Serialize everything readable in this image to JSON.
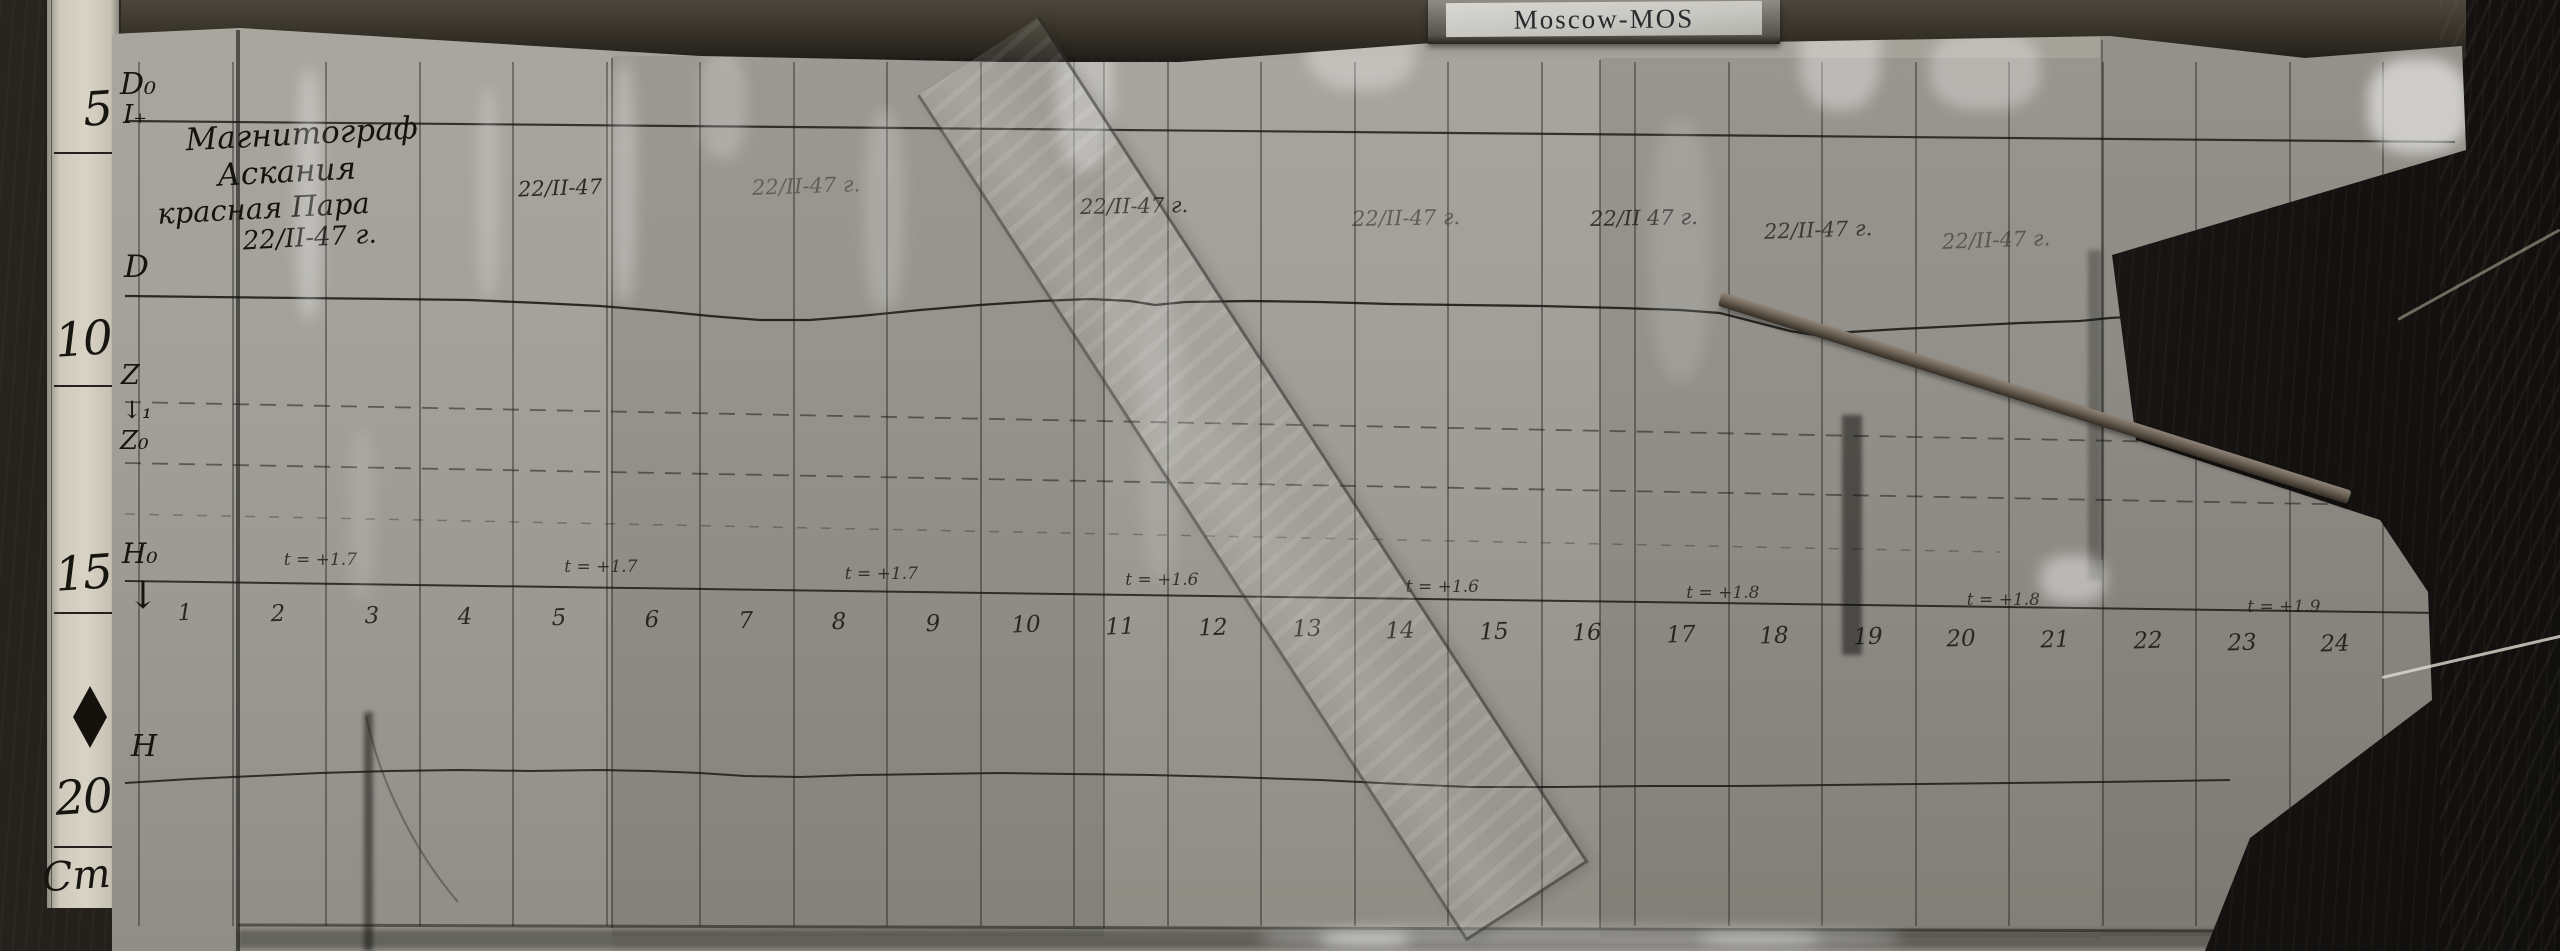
{
  "label_plate": {
    "text": "Moscow-MOS"
  },
  "colors": {
    "paper": "#a09b93",
    "wood": "#1e1c1a",
    "ink": "#1b1b1b",
    "ruler": "#d8d3c5"
  },
  "ruler": {
    "marks": [
      {
        "label": "5",
        "text_y": 86,
        "line_y": 152
      },
      {
        "label": "10",
        "text_y": 316,
        "line_y": 385
      },
      {
        "label": "15",
        "text_y": 550,
        "line_y": 612
      },
      {
        "label": "20",
        "text_y": 774,
        "line_y": 846
      }
    ],
    "unit": {
      "label": "Cm",
      "text_y": 856
    }
  },
  "title_block": {
    "lines": [
      {
        "text": "Магнитограф",
        "size": 31,
        "indent": 40
      },
      {
        "text": "Аскания",
        "size": 31,
        "indent": 70
      },
      {
        "text": "красная Пара",
        "size": 29,
        "indent": 8
      },
      {
        "text": "22/II-47 г.",
        "size": 26,
        "indent": 92
      }
    ]
  },
  "margin_labels": [
    {
      "label": "D₀",
      "x": 120,
      "y": 70,
      "s": 30
    },
    {
      "label": "I₊",
      "x": 123,
      "y": 102,
      "s": 26
    },
    {
      "label": "D",
      "x": 124,
      "y": 252,
      "s": 31
    },
    {
      "label": "Z",
      "x": 121,
      "y": 362,
      "s": 27
    },
    {
      "label": "↓₁",
      "x": 122,
      "y": 398,
      "s": 24
    },
    {
      "label": "Z₀",
      "x": 120,
      "y": 428,
      "s": 26
    },
    {
      "label": "H₀",
      "x": 122,
      "y": 540,
      "s": 28
    },
    {
      "label": "↓",
      "x": 127,
      "y": 576,
      "s": 38
    },
    {
      "label": "H",
      "x": 131,
      "y": 732,
      "s": 30
    }
  ],
  "dates": [
    {
      "label": "22/II-47",
      "x": 518,
      "y": 176,
      "o": 0.9,
      "r": -2
    },
    {
      "label": "22/II-47 г.",
      "x": 752,
      "y": 174,
      "o": 0.45,
      "r": -2
    },
    {
      "label": "22/II-47 г.",
      "x": 1080,
      "y": 194,
      "o": 0.85,
      "r": -1
    },
    {
      "label": "22/II-47 г.",
      "x": 1352,
      "y": 206,
      "o": 0.5,
      "r": -1
    },
    {
      "label": "22/II 47 г.",
      "x": 1590,
      "y": 206,
      "o": 0.8,
      "r": -1
    },
    {
      "label": "22/II-47 г.",
      "x": 1764,
      "y": 218,
      "o": 0.75,
      "r": -2
    },
    {
      "label": "22/II-47 г.",
      "x": 1942,
      "y": 228,
      "o": 0.5,
      "r": -2
    }
  ],
  "time_axis": {
    "hours": [
      "1",
      "2",
      "3",
      "4",
      "5",
      "6",
      "7",
      "8",
      "9",
      "10",
      "11",
      "12",
      "13",
      "14",
      "15",
      "16",
      "17",
      "18",
      "19",
      "20",
      "21",
      "22",
      "23",
      "24"
    ]
  },
  "temperature_notes": [
    {
      "hour": 3,
      "label": "t = +1.7"
    },
    {
      "hour": 6,
      "label": "t = +1.7"
    },
    {
      "hour": 9,
      "label": "t = +1.7"
    },
    {
      "hour": 12,
      "label": "t = +1.6"
    },
    {
      "hour": 15,
      "label": "t = +1.6"
    },
    {
      "hour": 18,
      "label": "t = +1.8"
    },
    {
      "hour": 21,
      "label": "t = +1.8"
    },
    {
      "hour": 24,
      "label": "t = +1.9"
    }
  ],
  "baselines": [
    {
      "x1": 125,
      "y1": 121,
      "x2": 2455,
      "y2": 142,
      "w": 2.2,
      "o": 0.8,
      "dash": ""
    },
    {
      "x1": 125,
      "y1": 402,
      "x2": 2428,
      "y2": 447,
      "w": 1.8,
      "o": 0.5,
      "dash": "16 11"
    },
    {
      "x1": 125,
      "y1": 463,
      "x2": 2428,
      "y2": 506,
      "w": 1.8,
      "o": 0.5,
      "dash": "16 11"
    },
    {
      "x1": 125,
      "y1": 514,
      "x2": 2000,
      "y2": 552,
      "w": 1.5,
      "o": 0.3,
      "dash": "10 14"
    },
    {
      "x1": 125,
      "y1": 581,
      "x2": 2438,
      "y2": 613,
      "w": 2.0,
      "o": 0.8,
      "dash": ""
    },
    {
      "x1": 238,
      "y1": 925,
      "x2": 2228,
      "y2": 931,
      "w": 3.0,
      "o": 0.5,
      "dash": ""
    }
  ],
  "traces": {
    "d": [
      [
        125,
        296
      ],
      [
        210,
        297
      ],
      [
        300,
        298
      ],
      [
        390,
        299
      ],
      [
        470,
        300
      ],
      [
        540,
        303
      ],
      [
        600,
        306
      ],
      [
        660,
        311
      ],
      [
        710,
        316
      ],
      [
        760,
        320
      ],
      [
        810,
        320
      ],
      [
        860,
        316
      ],
      [
        920,
        310
      ],
      [
        980,
        305
      ],
      [
        1040,
        301
      ],
      [
        1090,
        299
      ],
      [
        1130,
        301
      ],
      [
        1155,
        305
      ],
      [
        1185,
        302
      ],
      [
        1250,
        301
      ],
      [
        1320,
        302
      ],
      [
        1390,
        304
      ],
      [
        1460,
        305
      ],
      [
        1540,
        306
      ],
      [
        1620,
        308
      ],
      [
        1680,
        310
      ],
      [
        1720,
        313
      ],
      [
        1755,
        322
      ],
      [
        1790,
        331
      ],
      [
        1815,
        335
      ],
      [
        1850,
        332
      ],
      [
        1900,
        329
      ],
      [
        1960,
        326
      ],
      [
        2020,
        323
      ],
      [
        2080,
        321
      ],
      [
        2110,
        318
      ],
      [
        2160,
        315
      ],
      [
        2220,
        312
      ],
      [
        2290,
        309
      ],
      [
        2350,
        306
      ],
      [
        2400,
        302
      ],
      [
        2425,
        296
      ]
    ],
    "h": [
      [
        125,
        783
      ],
      [
        190,
        779
      ],
      [
        255,
        776
      ],
      [
        320,
        773
      ],
      [
        390,
        771
      ],
      [
        460,
        770
      ],
      [
        530,
        771
      ],
      [
        600,
        770
      ],
      [
        650,
        771
      ],
      [
        700,
        773
      ],
      [
        745,
        776
      ],
      [
        800,
        777
      ],
      [
        860,
        775
      ],
      [
        930,
        774
      ],
      [
        1000,
        773
      ],
      [
        1070,
        774
      ],
      [
        1150,
        775
      ],
      [
        1230,
        777
      ],
      [
        1320,
        780
      ],
      [
        1400,
        784
      ],
      [
        1470,
        787
      ],
      [
        1560,
        787
      ],
      [
        1650,
        786
      ],
      [
        1740,
        786
      ],
      [
        1830,
        785
      ],
      [
        1920,
        784
      ],
      [
        2010,
        783
      ],
      [
        2100,
        782
      ],
      [
        2170,
        781
      ],
      [
        2230,
        780
      ]
    ]
  }
}
